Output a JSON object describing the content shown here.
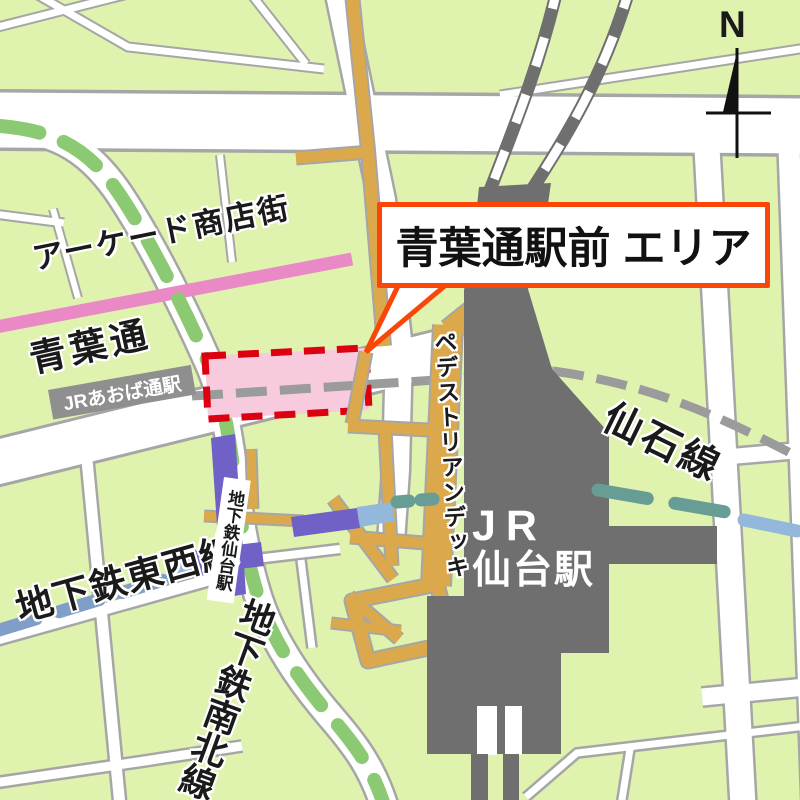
{
  "labels": {
    "arcade_street": "アーケード商店街",
    "aoba_dori": "青葉通",
    "callout_area": "青葉通駅前 エリア",
    "jr_aobadori_station": "JRあおば通駅",
    "pedestrian_deck": "ペデストリアンデッキ",
    "jr_sendai_station_line1": "JR",
    "jr_sendai_station_line2": "仙台駅",
    "senseki_line": "仙石線",
    "subway_sendai_station": "地下鉄仙台駅",
    "subway_tozai_line": "地下鉄東西線",
    "subway_namboku_line": "地下鉄南北線",
    "compass_north": "N"
  },
  "colors": {
    "bg-green": "#dff3ae",
    "casing-gray": "#a6a6a6",
    "arcade-pink": "#e98ac6",
    "green-line": "#8cc973",
    "blue-line": "#7f9fc8",
    "teal-line": "#689d96",
    "lightblue-line": "#93b8dc",
    "purple": "#6f61c6",
    "orange-road": "#dba94c",
    "building-gray": "#6f6f6f",
    "gray-dash": "#9b9b9b",
    "highlight-pink": "#f8cadd",
    "highlight-red": "#dc0011",
    "callout-red": "#f84708",
    "badge-gray": "#8f8f8f",
    "label-black": "#1a1a1a"
  }
}
